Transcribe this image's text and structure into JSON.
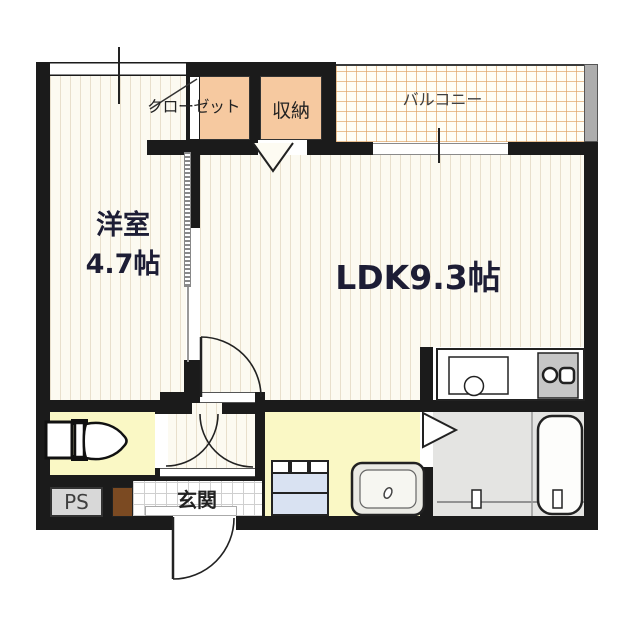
{
  "plan_title": "1LDK apartment floor plan",
  "rooms": {
    "western_room": {
      "name_label": "洋室",
      "size_label": "4.7帖"
    },
    "ldk": {
      "label": "LDK9.3帖"
    },
    "closet": {
      "label": "クローゼット"
    },
    "storage": {
      "label": "収納"
    },
    "balcony": {
      "label": "バルコニー"
    },
    "entrance": {
      "label": "玄関"
    },
    "pipe_space": {
      "label": "PS"
    }
  },
  "colors": {
    "wall": "#1b1b1b",
    "closet_fill": "#F6C9A0",
    "wet_room_fill": "#FAF8C5",
    "bathroom_fill": "#E4E4E2",
    "balcony_grid_line": "#DEA05F",
    "floor_stripe": "#E8DFCC",
    "drawer_fill": "#D9E2F2",
    "ps_box_fill": "#D8D8D8",
    "shoe_box_fill": "#7B4A22"
  }
}
